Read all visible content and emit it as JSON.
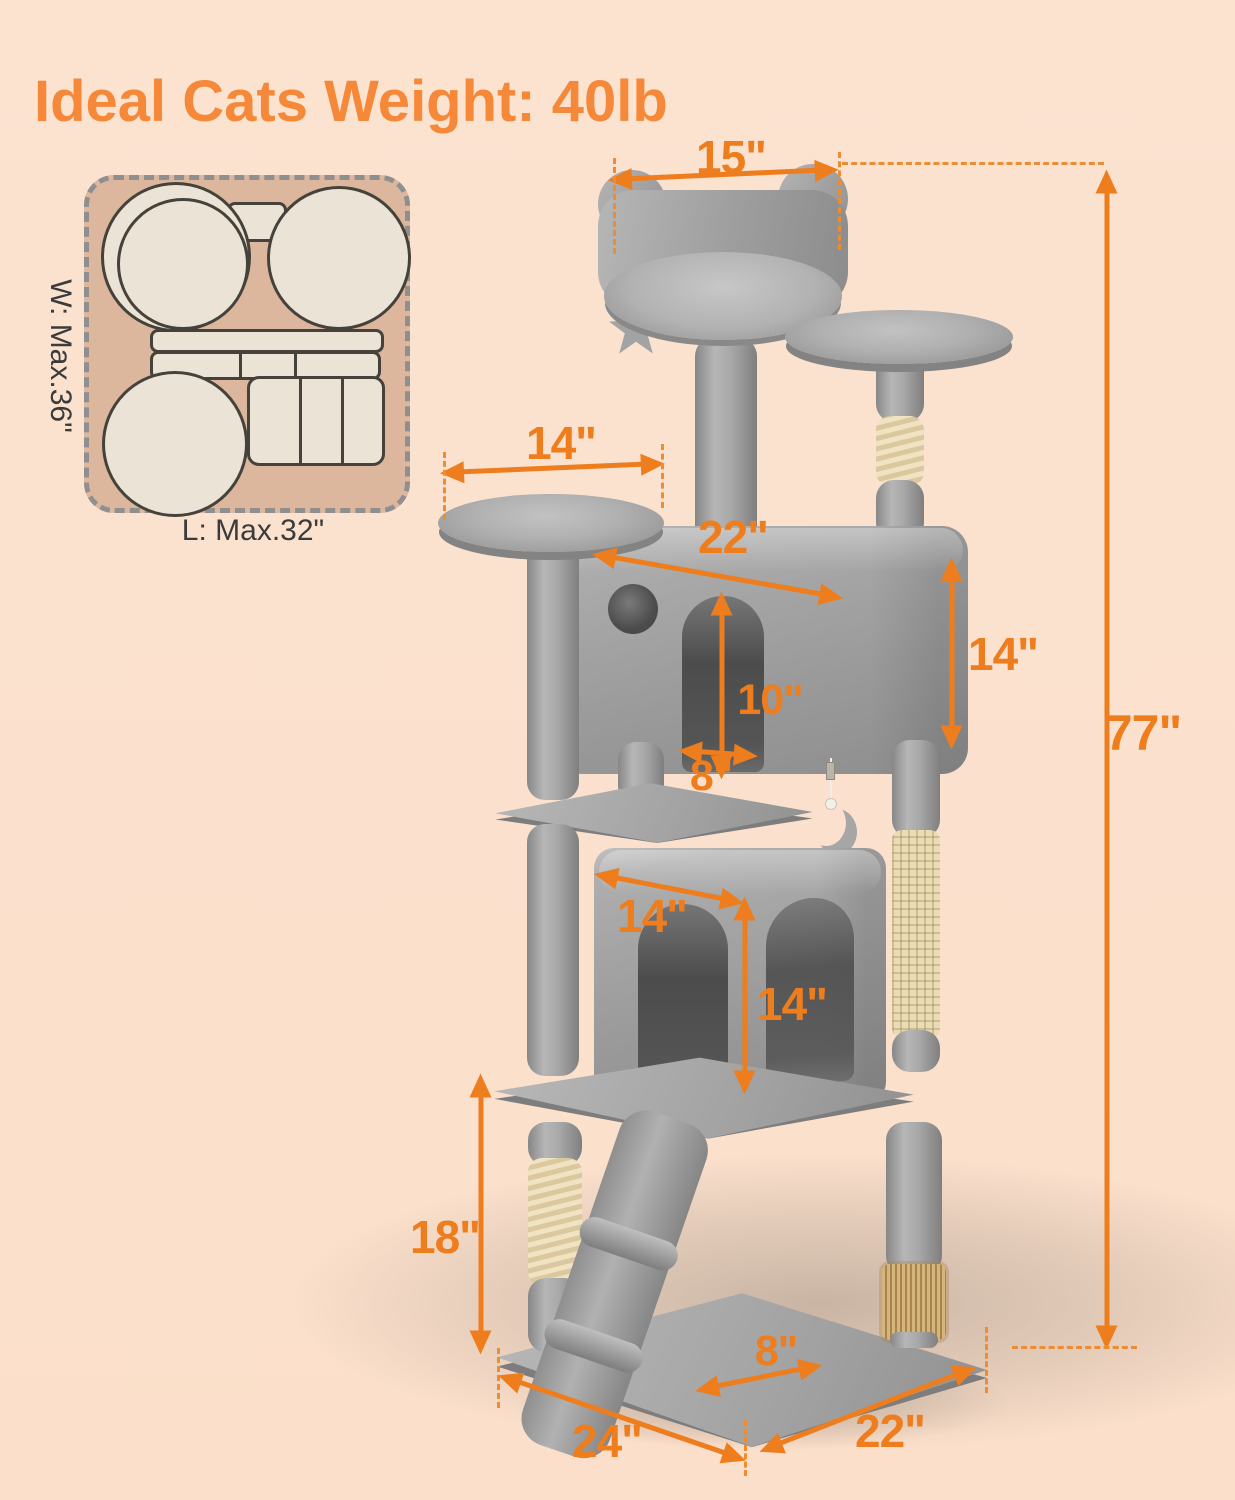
{
  "title": "Ideal Cats Weight: 40lb",
  "footprint": {
    "width_label": "W: Max.36\"",
    "length_label": "L: Max.32\""
  },
  "dims": {
    "top_perch_width": "15\"",
    "overall_height": "77\"",
    "upper_platform_diameter": "14\"",
    "upper_condo_width": "22\"",
    "upper_condo_door_height": "10\"",
    "upper_condo_door_width": "8\"",
    "upper_condo_height": "14\"",
    "lower_condo_width": "14\"",
    "lower_condo_height": "14\"",
    "lower_post_height": "18\"",
    "ramp_width": "8\"",
    "base_length": "24\"",
    "base_depth": "22\""
  },
  "colors": {
    "background": "#fbe1cd",
    "accent_orange": "#ee7d1e",
    "title_orange": "#f6883a",
    "dashed_orange": "#ec8c33",
    "tree_gray": "#9e9e9e",
    "sisal_beige": "#ecdcb4",
    "inset_background": "#dcb79e",
    "inset_shape_cream": "#ebe4d6"
  }
}
